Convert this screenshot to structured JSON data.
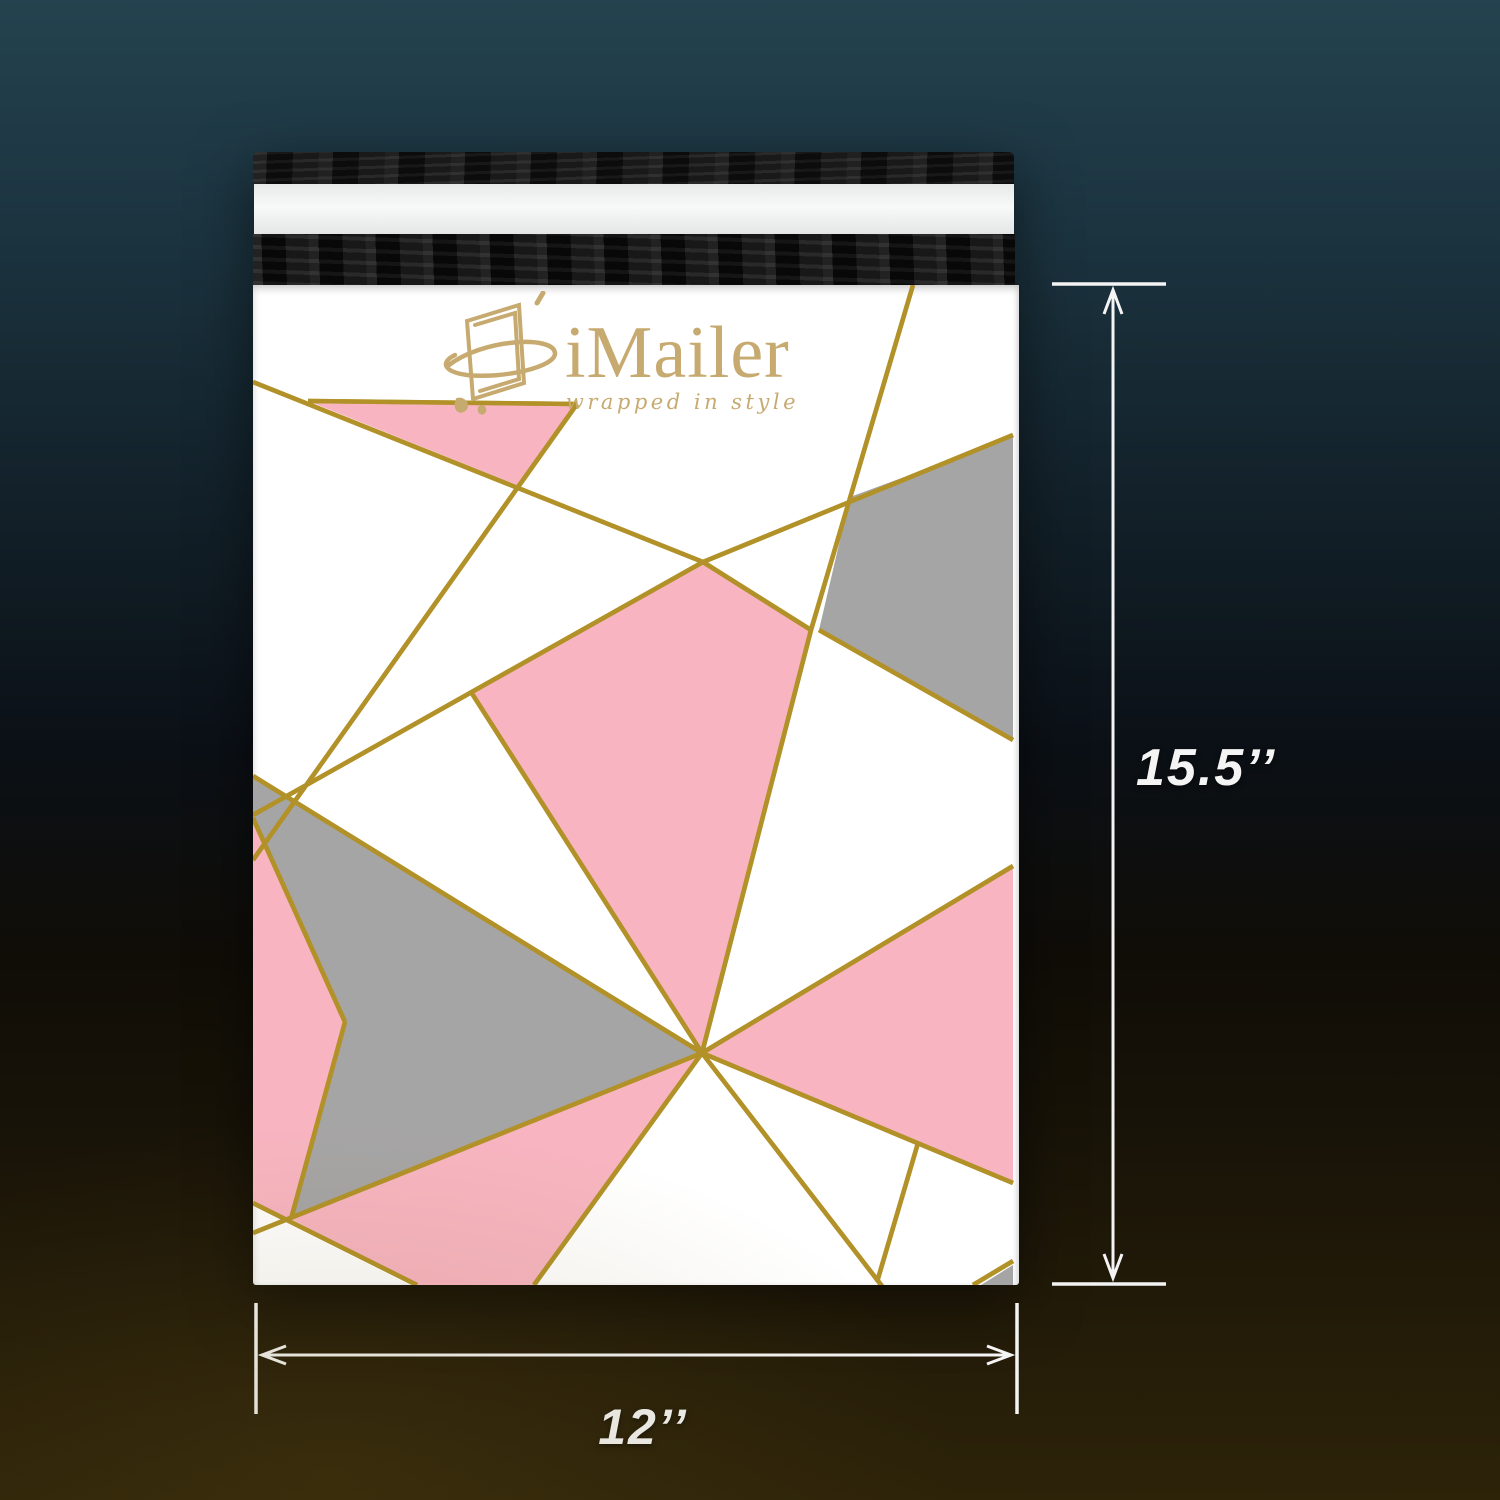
{
  "product": {
    "brand": "iMailer",
    "tagline": "wrapped in style"
  },
  "dimensions": {
    "height_label": "15.5’’",
    "width_label": "12’’"
  },
  "colors": {
    "bg_top": "#24424f",
    "bg_mid": "#0b1016",
    "bg_bottom": "#2d2309",
    "envelope_white": "#ffffff",
    "flap_black": "#161616",
    "liner_silver": "#eeeeee",
    "pink": "#f8b5c1",
    "gray": "#a6a5a6",
    "gold": "#b29228",
    "gold_bright": "#d9bd49",
    "logo_gold": "#c7aa70",
    "annotation_white": "#f4f4f4"
  }
}
